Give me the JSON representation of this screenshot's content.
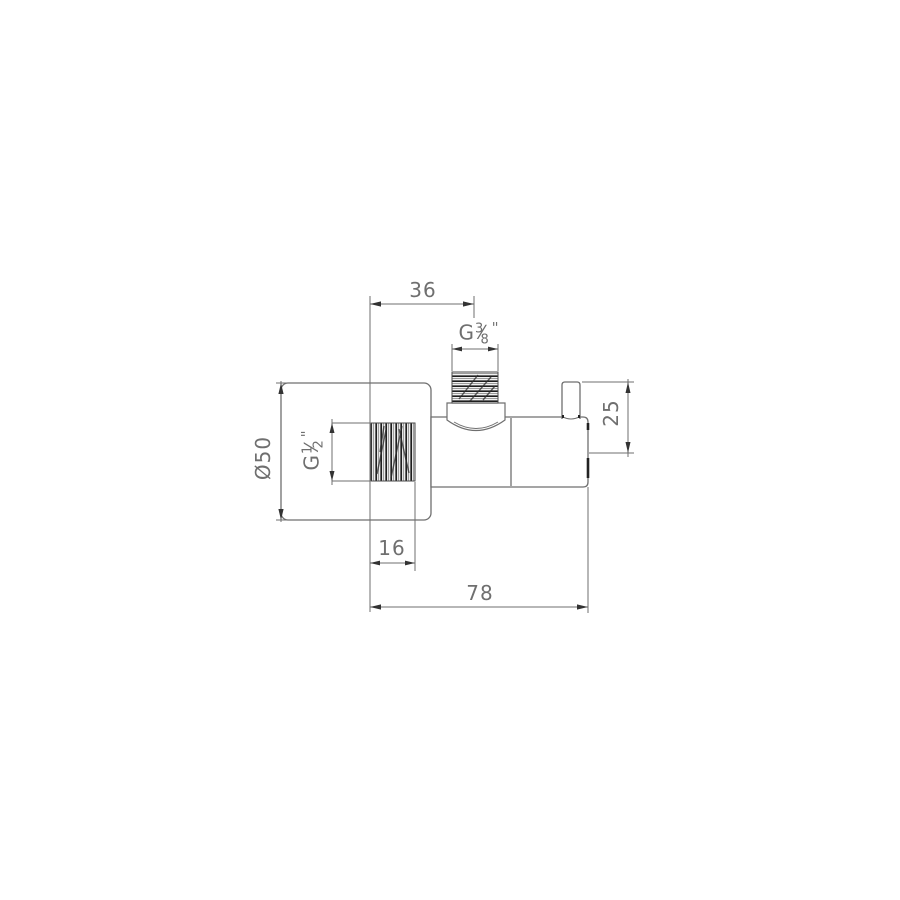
{
  "colors": {
    "background": "#ffffff",
    "line": "#6f6f6f",
    "text": "#6f6f6f",
    "arrow": "#333333",
    "thread_dark": "#1e1e1e"
  },
  "dimensions": {
    "top_offset": "36",
    "top_thread": {
      "prefix": "G",
      "numerator": "3",
      "denominator": "8",
      "suffix": "''"
    },
    "flange_diameter": "Ø50",
    "side_thread": {
      "prefix": "G",
      "numerator": "1",
      "denominator": "2",
      "suffix": "''"
    },
    "handle_height": "25",
    "thread_depth": "16",
    "total_depth": "78"
  }
}
